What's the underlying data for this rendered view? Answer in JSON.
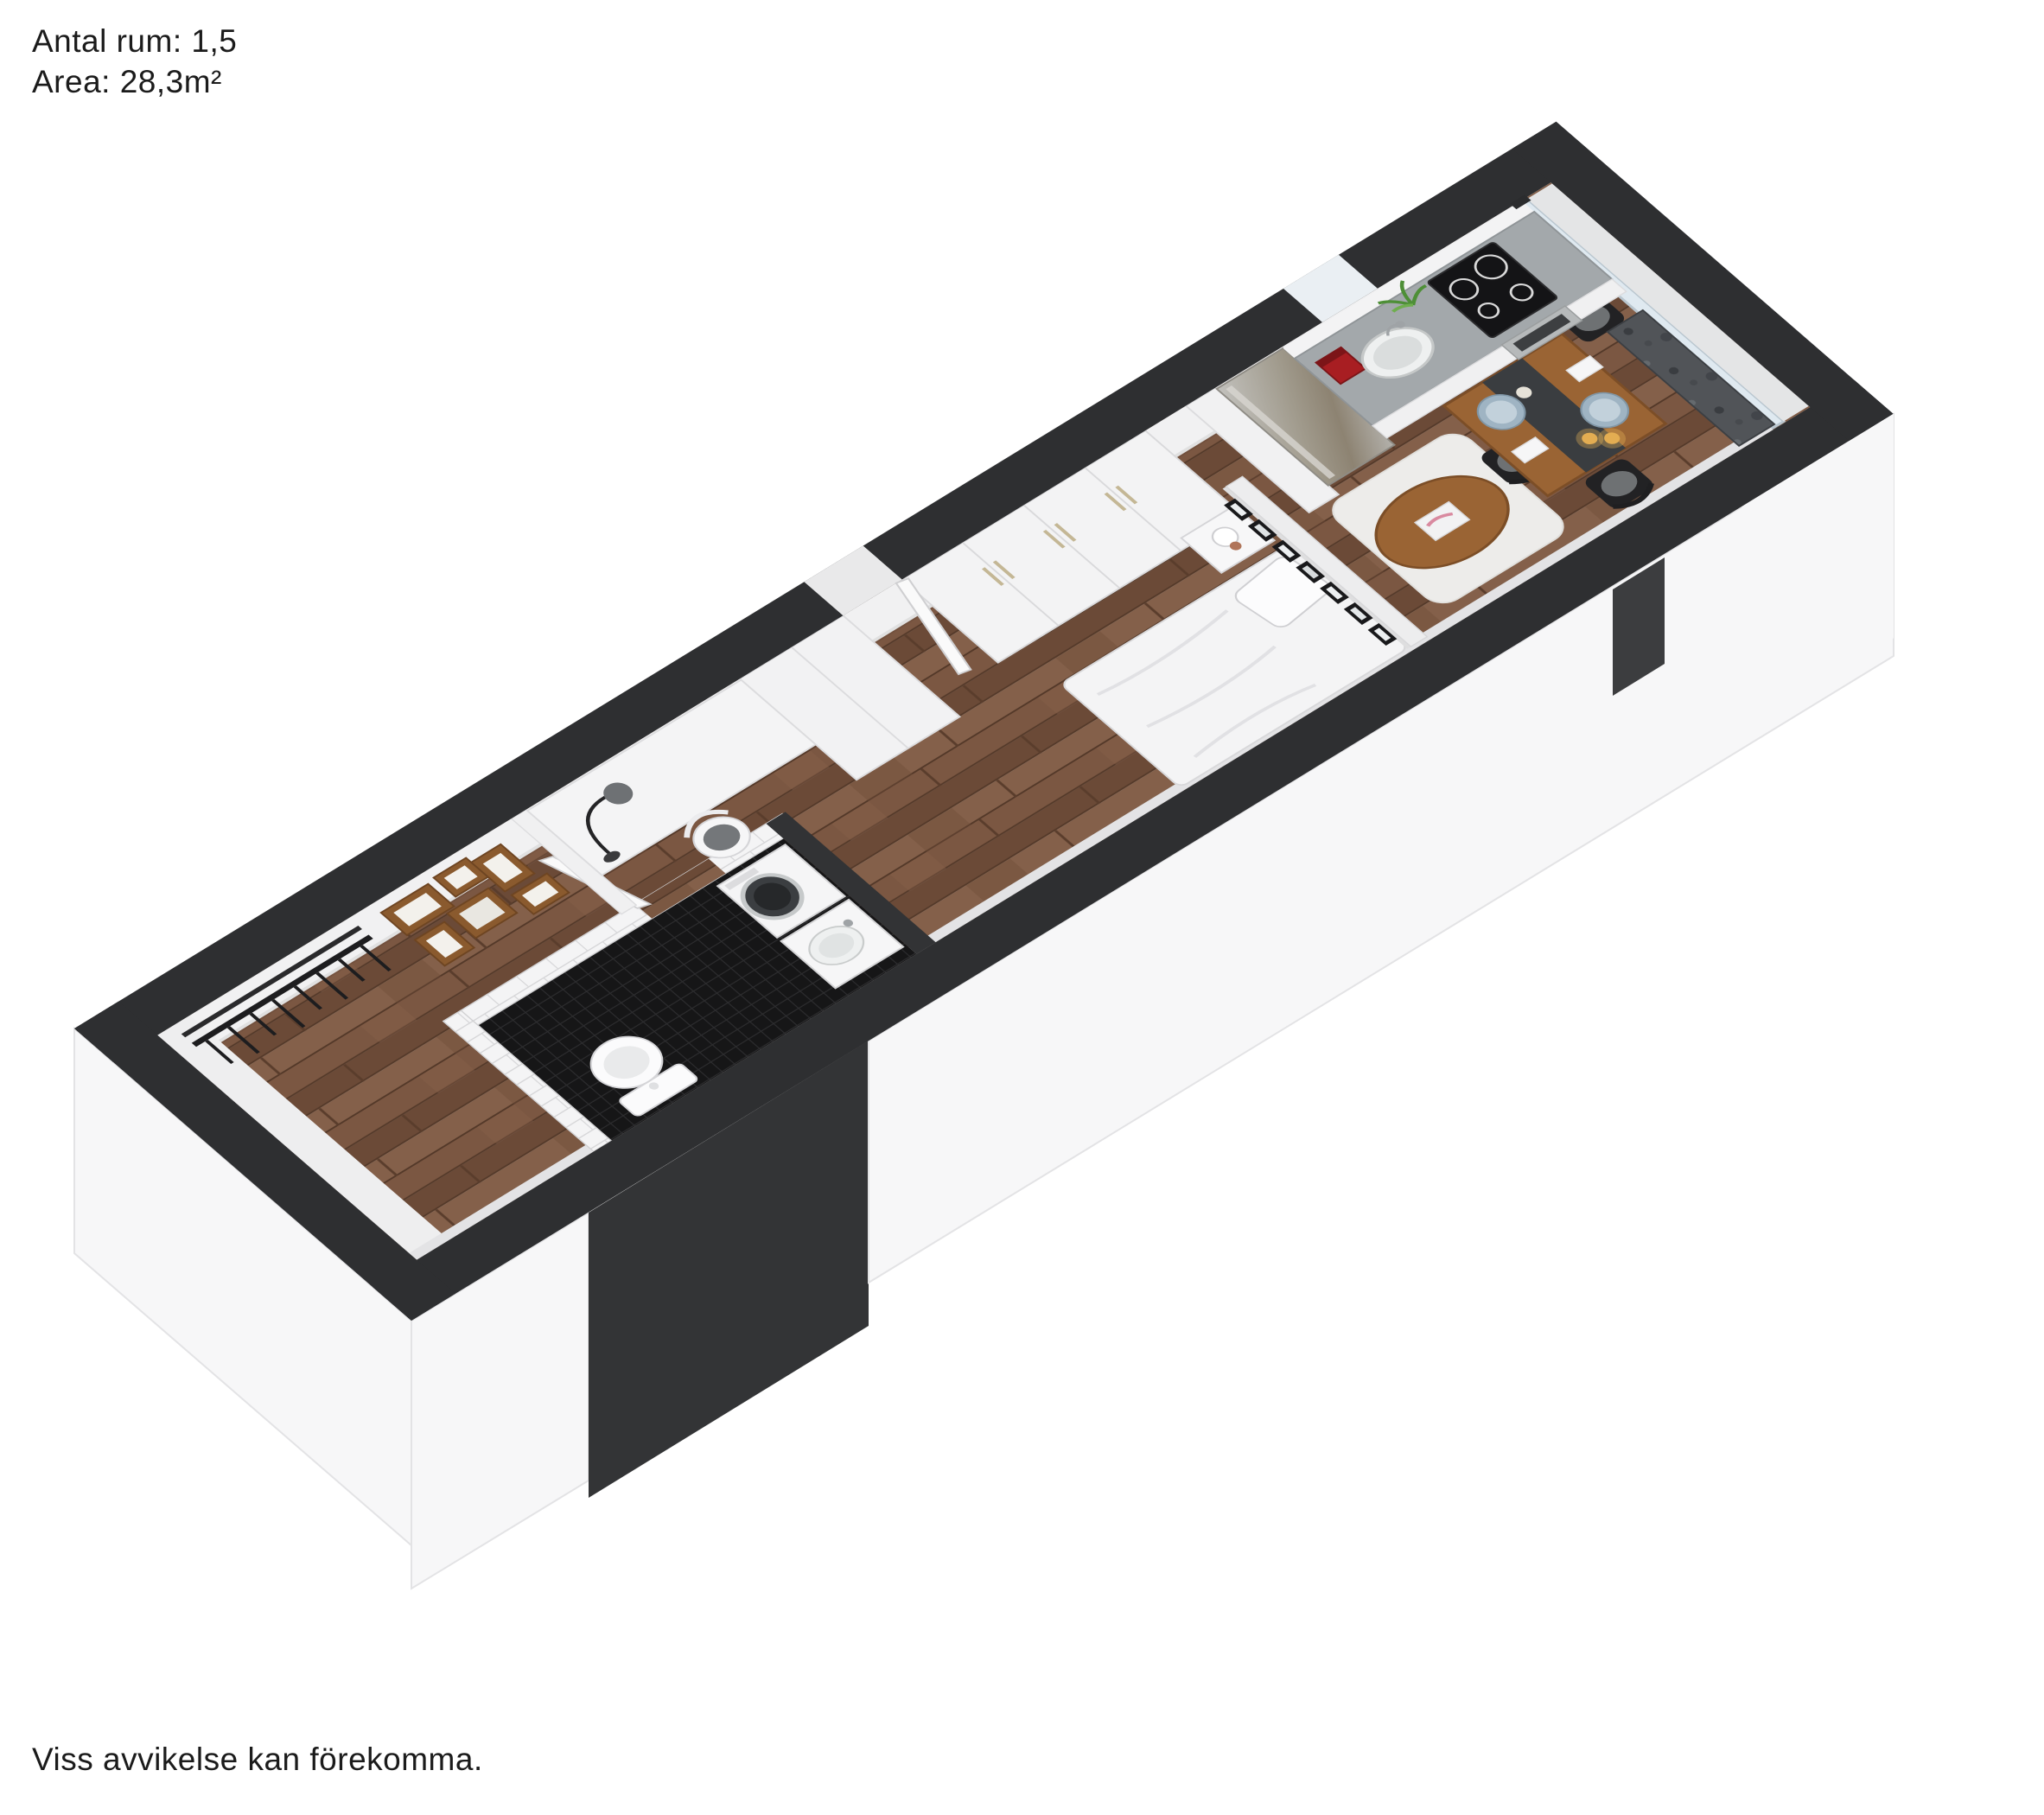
{
  "header": {
    "rooms_label": "Antal rum: 1,5",
    "area_label": "Area: 28,3m²"
  },
  "footer": {
    "disclaimer": "Viss avvikelse kan förekomma."
  },
  "palette": {
    "background": "#ffffff",
    "wall_cut": "#2e2f31",
    "wall_face": "#f1f1f2",
    "facade_white": "#f7f7f8",
    "facade_dark": "#333436",
    "floor_wood": "#7b5742",
    "floor_wood_dark": "#6b4a37",
    "floor_wood_light": "#84604a",
    "bathroom_floor": "#161617",
    "tile_white": "#f4f4f5",
    "glass": "#dfe9f0",
    "balcony_floor": "#e4e5e6",
    "counter": "#a3a8ab",
    "steel": "#a8a5a0",
    "granite": "#515458",
    "table_wood": "#9a6434",
    "accent_red": "#a81e22",
    "copper": "#b0755a",
    "plant_green": "#4e8f37",
    "plate_blue": "#9fb4c3",
    "candle": "#e0a94f",
    "chair_black": "#222224",
    "frame_brown": "#8a5a2e"
  },
  "scene": {
    "type": "3d-floorplan-rendering",
    "rooms": [
      "hall",
      "bathroom",
      "sleeping-alcove",
      "living-area",
      "dining-area",
      "kitchen",
      "balcony"
    ],
    "furniture": [
      "coat-rack",
      "wall-frames",
      "partition-wall",
      "desk",
      "arc-lamp",
      "desk-chair",
      "high-cabinet",
      "entry-door",
      "wardrobes",
      "washing-machine",
      "bathroom-sink",
      "bathroom-door",
      "toilet",
      "bed",
      "pillow",
      "nightstand",
      "globe-lamp",
      "gallery-frames",
      "rug",
      "coffee-table",
      "magazine",
      "dining-table",
      "table-runner",
      "plates",
      "menu-cards",
      "candles",
      "dining-chairs",
      "refrigerator",
      "kitchen-counter",
      "kitchen-sink",
      "faucet",
      "coffee-machine",
      "plant",
      "cooktop",
      "oven",
      "stone-bench",
      "glass-wall"
    ]
  }
}
